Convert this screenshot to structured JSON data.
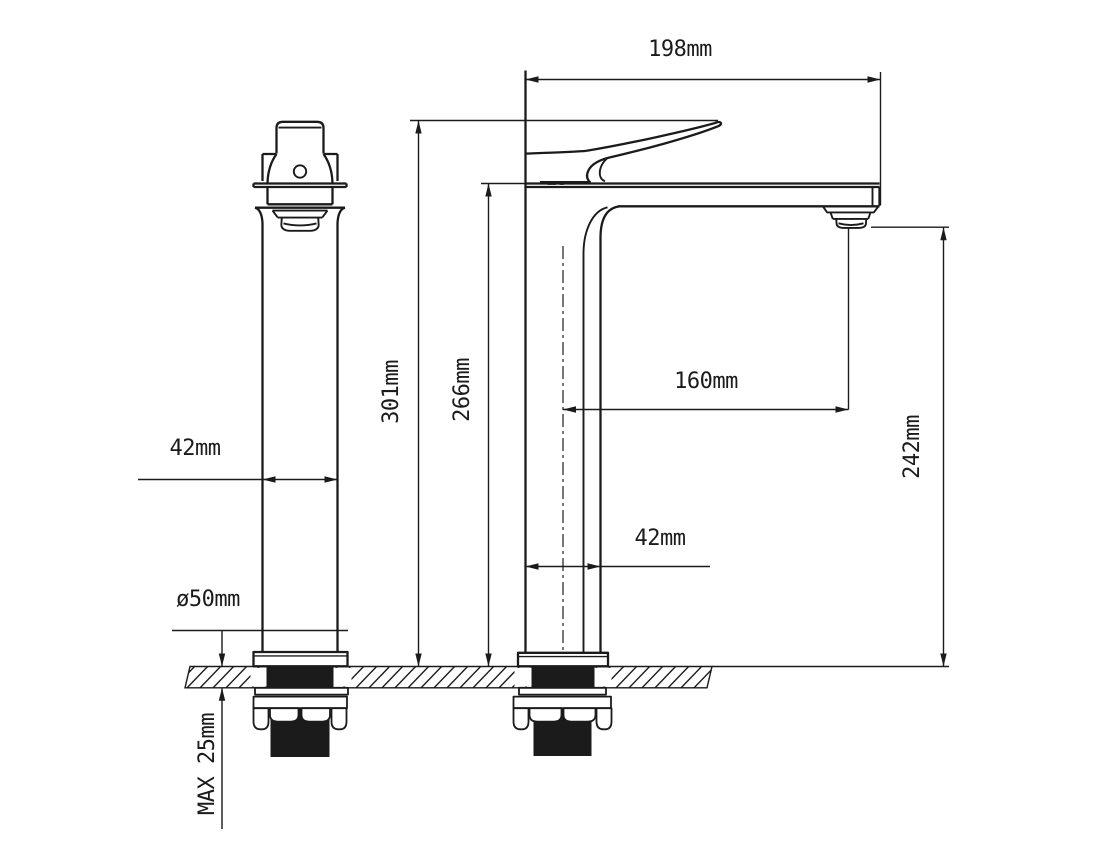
{
  "drawing": {
    "background": "#ffffff",
    "line_color": "#1b1b1b",
    "labels": {
      "spout_width": "198mm",
      "overall_height": "301mm",
      "height_to_spout_base": "266mm",
      "spout_reach": "160mm",
      "spout_outlet_height": "242mm",
      "body_width_side_view": "42mm",
      "body_width_front_view": "42mm",
      "base_diameter": "ø50mm",
      "max_mounting_thickness": "MAX 25mm"
    }
  }
}
